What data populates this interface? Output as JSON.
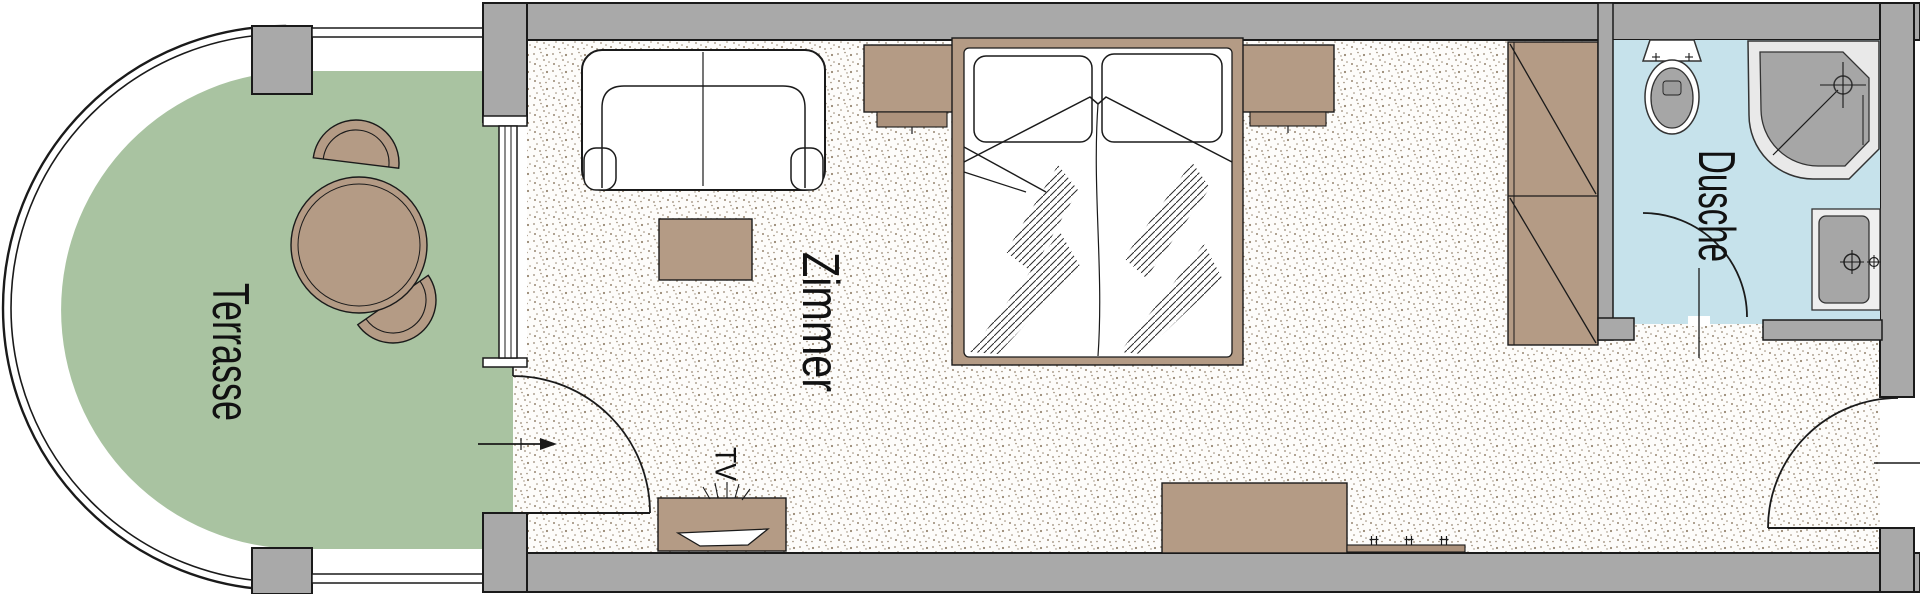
{
  "labels": {
    "terrace": "Terrasse",
    "room": "Zimmer",
    "bath": "Dusche",
    "tv": "TV"
  },
  "colors": {
    "wall": "#a9a9a9",
    "outline": "#1a1a1a",
    "terrace": "#a9c3a1",
    "wood": "#b49b85",
    "wood_dark": "#ac927c",
    "bath": "#c6e2eb",
    "fixture": "#a6a6a6",
    "fixture_light": "#e9e9e9",
    "floor": "#fdfcfa",
    "speckle": "#8c7a63"
  }
}
